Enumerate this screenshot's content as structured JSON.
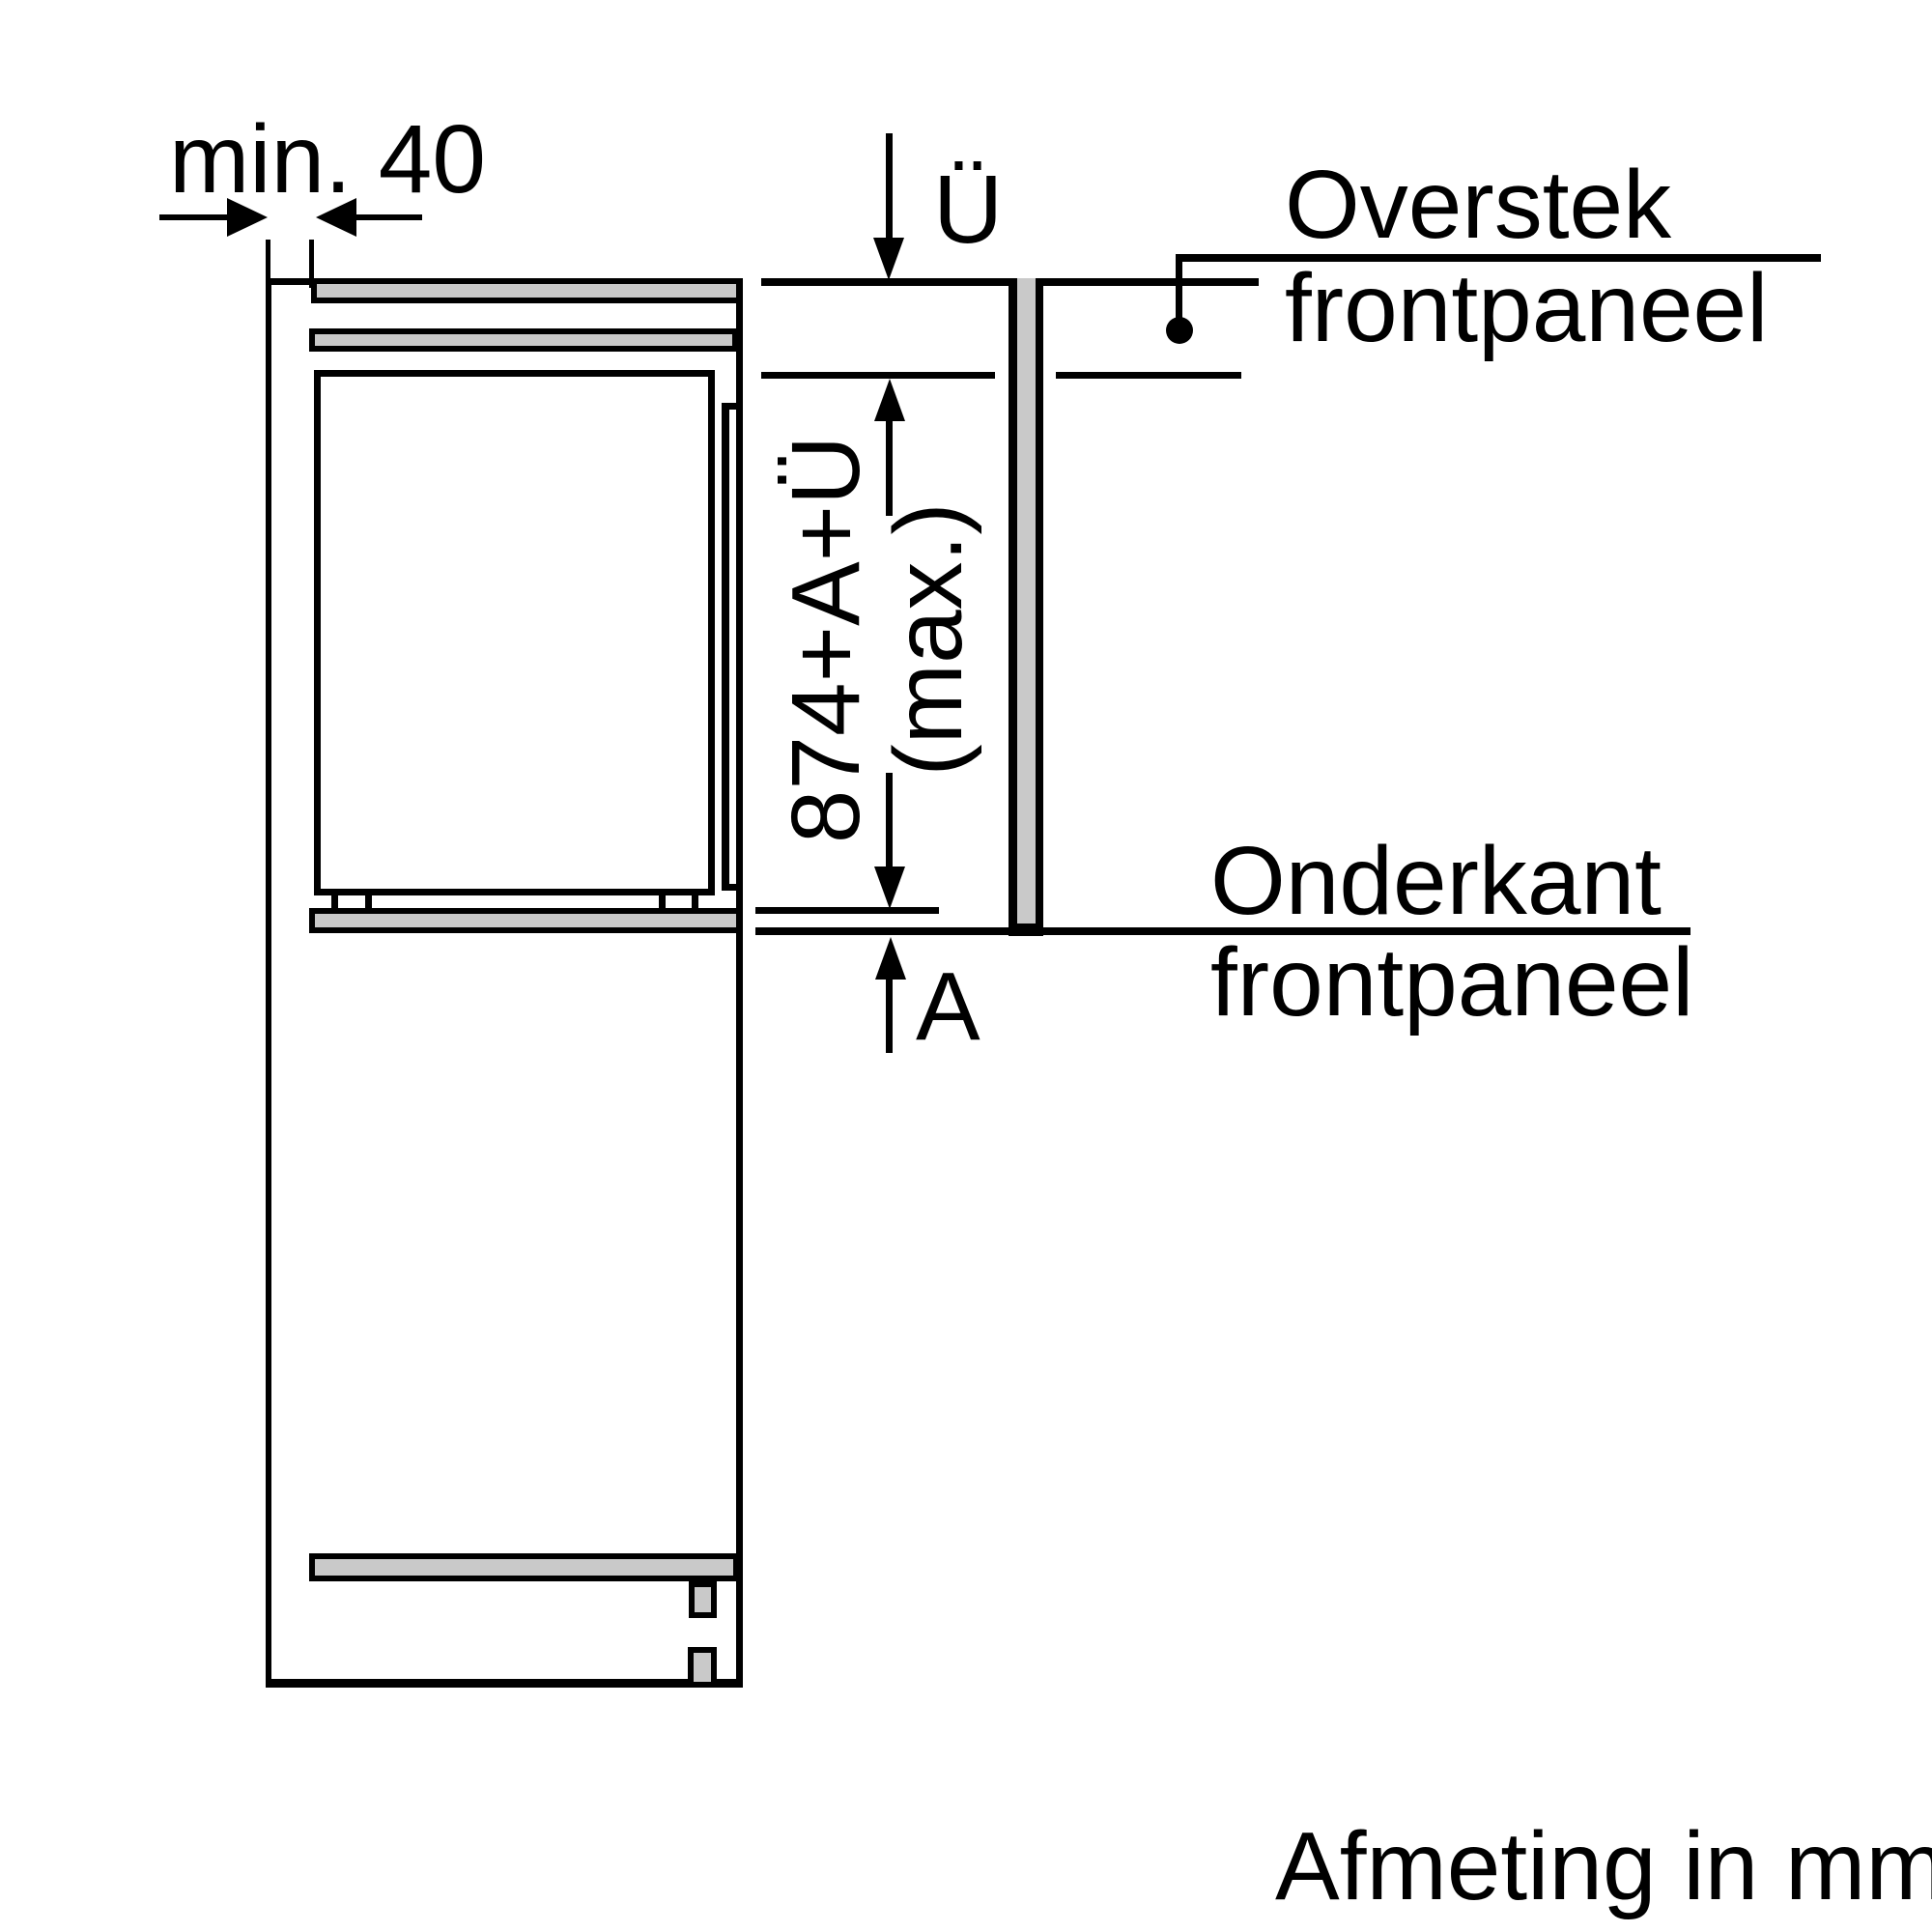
{
  "diagram": {
    "title": "Afmeting in mm",
    "dimensions": {
      "min_gap_label": "min. 40",
      "overhang_label": "Ü",
      "panel_height_line1": "874+A+Ü",
      "panel_height_line2": "(max.)",
      "bottom_gap_label": "A"
    },
    "callouts": {
      "overstek_line1": "Overstek",
      "overstek_line2": "frontpaneel",
      "onderkant_line1": "Onderkant",
      "onderkant_line2": "frontpaneel"
    },
    "colors": {
      "line": "#000000",
      "panel_fill": "#c9c9c9",
      "background": "#ffffff"
    }
  }
}
